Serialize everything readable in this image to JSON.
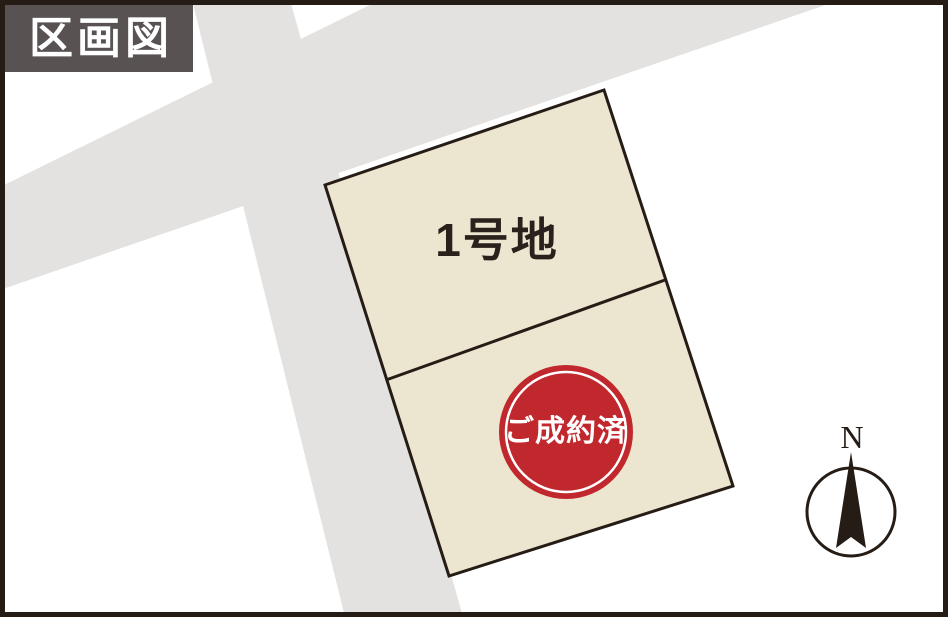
{
  "header": {
    "title": "区画図"
  },
  "plot_map": {
    "lot1": {
      "label": "1号地",
      "status": "available"
    },
    "lot2": {
      "sold_badge": "ご成約済",
      "status": "sold"
    },
    "compass": {
      "north_label": "N"
    }
  },
  "colors": {
    "lot_fill": "#ece5d0",
    "road_fill": "#e3e2e1",
    "line_color": "#261c16",
    "header_bg": "#585252",
    "sold_red": "#c0282d",
    "text_dark": "#2a211d",
    "bg_white": "#ffffff"
  }
}
